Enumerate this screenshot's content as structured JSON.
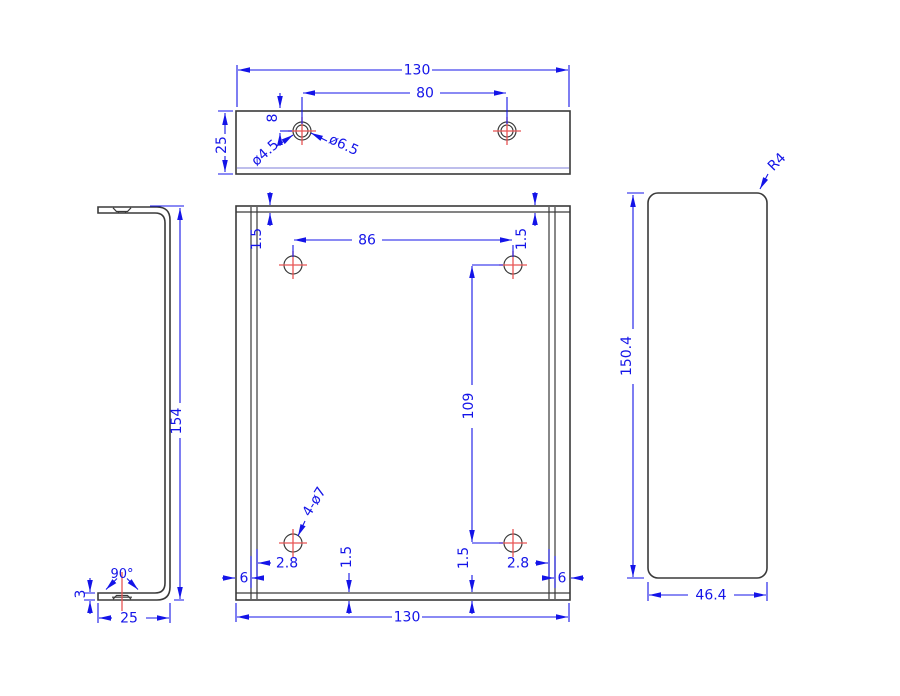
{
  "drawing": {
    "title": "sheet-metal bracket orthographic drawing",
    "colors": {
      "geometry": "#3a3a3a",
      "dimension": "#1414e8",
      "centerline": "#e85555",
      "background": "#ffffff"
    },
    "top_view": {
      "width": "130",
      "hole_spacing": "80",
      "depth": "25",
      "hole_offset": "8",
      "csk_diameter": "ø4.5",
      "bore_diameter": "ø6.5"
    },
    "front_view": {
      "hole_spacing_x": "86",
      "hole_spacing_y": "109",
      "width": "130",
      "thickness_top_left": "1.5",
      "thickness_top_right": "1.5",
      "thickness_bottom_left": "1.5",
      "thickness_bottom_right": "1.5",
      "hole_edge_left": "2.8",
      "hole_edge_right": "2.8",
      "flange_left": "6",
      "flange_right": "6",
      "hole_callout": "4-ø7"
    },
    "side_view": {
      "height": "154",
      "depth": "25",
      "thickness": "3",
      "csk_angle": "90°"
    },
    "end_view": {
      "height": "150.4",
      "width": "46.4",
      "corner_radius": "R4"
    }
  }
}
